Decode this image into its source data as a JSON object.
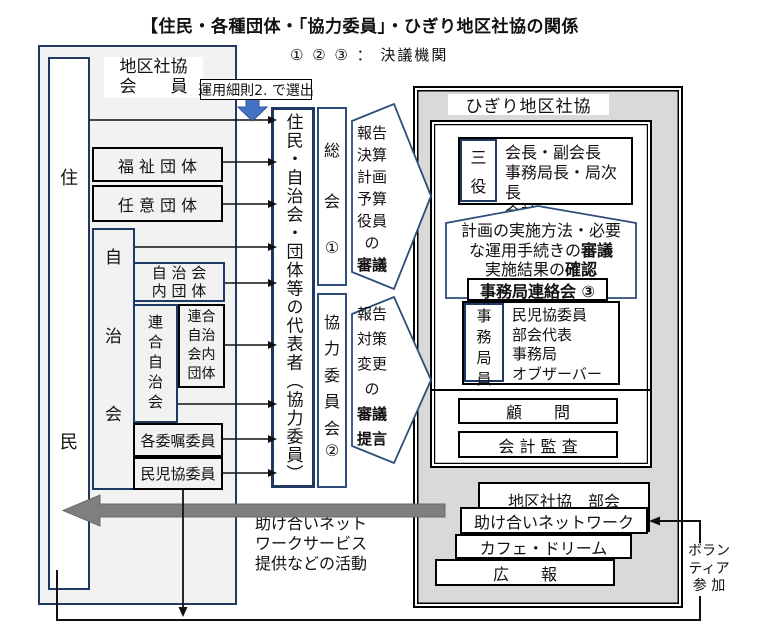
{
  "colors": {
    "navy": "#1f3864",
    "steel_blue": "#2e4d7b",
    "accent_blue": "#4472c4",
    "panel_gray": "#d9d9d9",
    "panel_light": "#f2f2f2",
    "arrow_gray": "#7f7f7f",
    "line_black": "#111111"
  },
  "title": "【住民・各種団体・「協力委員」・ひぎり地区社協の関係",
  "legend": "① ② ③ ： 決議機関",
  "left_panel": {
    "member_label": [
      "地区社協",
      "会　　員"
    ],
    "selection_note": "運用細則2. で選出",
    "resident_chars": [
      "住",
      "民"
    ],
    "fukushi": "福 祉 団 体",
    "nini": "任 意 団 体",
    "jichikai_chars": [
      "自",
      "治",
      "会"
    ],
    "jichikai_inner": [
      "自 治 会",
      "内 団 体"
    ],
    "rengo": "連合自治会",
    "rengo_inner": [
      "連合",
      "自治",
      "会内",
      "団体"
    ],
    "kakuishoku": "各委嘱委員",
    "minjikyo": "民児協委員"
  },
  "middle": {
    "reps": "住民・自治会・団体等の代表者（協力委員）",
    "soukai": [
      "総",
      "会",
      "①"
    ],
    "kyoryoku": [
      "協",
      "力",
      "委",
      "員",
      "会",
      "②"
    ],
    "flow1": [
      "報告",
      "決算",
      "計画",
      "予算",
      "役員",
      "の",
      "審議"
    ],
    "flow2": [
      "報告",
      "対策",
      "変更",
      "の",
      "審議",
      "提言"
    ],
    "activity_note": [
      "助け合いネット",
      "ワークサービス",
      "提供などの活動"
    ]
  },
  "right_panel": {
    "header": "ひぎり地区社協",
    "sanyaku_chars": [
      "三",
      "役"
    ],
    "sanyaku_members": [
      "会長・副会長",
      "事務局長・局次長",
      "会計"
    ],
    "chevron": {
      "line1": "計画の実施方法・必要",
      "line2_pre": "な運用手続きの",
      "line2_bold": "審議",
      "line3_pre": "実施結果の",
      "line3_bold": "確認"
    },
    "renrakukai": "事務局連絡会 ③",
    "jimukyoku_chars": [
      "事",
      "務",
      "局",
      "員"
    ],
    "jimukyoku_members": [
      "民児協委員",
      "部会代表",
      "事務局",
      "オブザーバー"
    ],
    "advisor": "顧　　問",
    "audit": "会 計 監 査",
    "bukai": "地区社協　部会",
    "network": "助け合いネットワーク",
    "cafe": "カフェ・ドリーム",
    "pr": "広　　報"
  },
  "volunteer": [
    "ボラン",
    "ティア",
    "参 加"
  ]
}
